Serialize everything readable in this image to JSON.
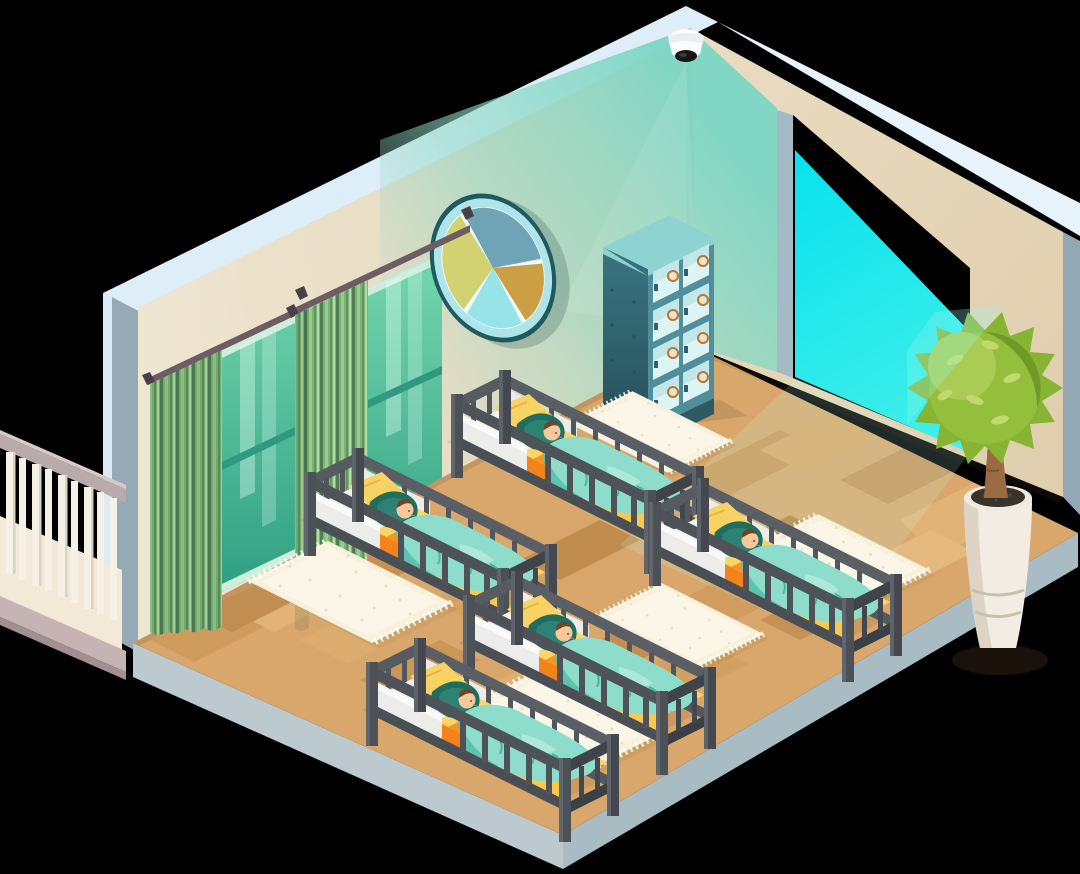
{
  "scene": {
    "title": "Isometric nursery room with five cribs and sleeping babies",
    "background_color": "#000000",
    "room": {
      "left_wall_color": "#e8dcc3",
      "right_wall_color": "#e5d5b7",
      "wall_top_edge_color": "#ddeef8",
      "wall_end_cap_color": "#95a9b7",
      "corner_light_wash_color": "#8ed5c2",
      "floor_base_color": "#d9a76c",
      "floor_plank_colors": [
        "#cf9b5c",
        "#e3b276",
        "#c89150",
        "#dcab6e",
        "#d4a263",
        "#e0b173"
      ],
      "floor_slab_left_color": "#bcc9ce",
      "floor_slab_right_color": "#a9bbc3"
    },
    "security_camera": {
      "count": 1,
      "dome_color": "#fdfdfd",
      "lens_color": "#161616",
      "mounted": "ceiling corner"
    },
    "light_opening": {
      "glow_color": "#0ce8ee",
      "jamb_color": "#a4bac4"
    },
    "windows": {
      "count": 2,
      "glass_top_color": "#6fd3ac",
      "glass_bottom_color": "#2e9e81",
      "frame_color": "#cdeedd"
    },
    "curtains": {
      "panel_count": 2,
      "stripe_colors": [
        "#7eb577",
        "#4e7e53",
        "#9ccb8b",
        "#5d9563",
        "#b7d7a4"
      ],
      "rod_color": "#6d5c64",
      "rod_count": 2
    },
    "wall_decor": {
      "shape": "segmented circle",
      "ring_color": "#aee4ea",
      "rim_color": "#1f5a60",
      "segment_colors": {
        "upper_right": "#6fa3b6",
        "lower_right": "#cc9f44",
        "bottom": "#96e4e8",
        "left": "#d3d273"
      }
    },
    "locker": {
      "rows": 4,
      "columns": 2,
      "cubbies": 8,
      "body_color": "#4f8e9a",
      "side_color": "#2e6671",
      "top_color": "#c3eeea",
      "pane_color": "#ddf4f5",
      "plate_color": "#b5763a"
    },
    "cribs": {
      "count": 5,
      "frame_color": "#4c5157",
      "mattress_color": "#fbd666",
      "accent_color": "#f5831c",
      "sheet_color": "#f2f2f0",
      "blanket_color": "#8edccb",
      "pillow_dark_color": "#1e6e62",
      "pillow_yellow_color": "#f8d263"
    },
    "babies": {
      "count": 5,
      "skin_color": "#f7c89c",
      "hair_color": "#6e4526",
      "state": "sleeping"
    },
    "rugs": {
      "count": 5,
      "color": "#f7f1de",
      "fringe_color": "#fffdf2"
    },
    "plant": {
      "count": 1,
      "foliage_color": "#87b433",
      "trunk_color": "#9a6b42",
      "pot_color": "#f2ece2",
      "soil_color": "#3a332c"
    },
    "balcony_railing": {
      "rail_color": "#b9abab",
      "base_color": "#c6b4b4",
      "baluster_color": "#f6f1e6",
      "deck_color": "#f3e9d8"
    }
  }
}
